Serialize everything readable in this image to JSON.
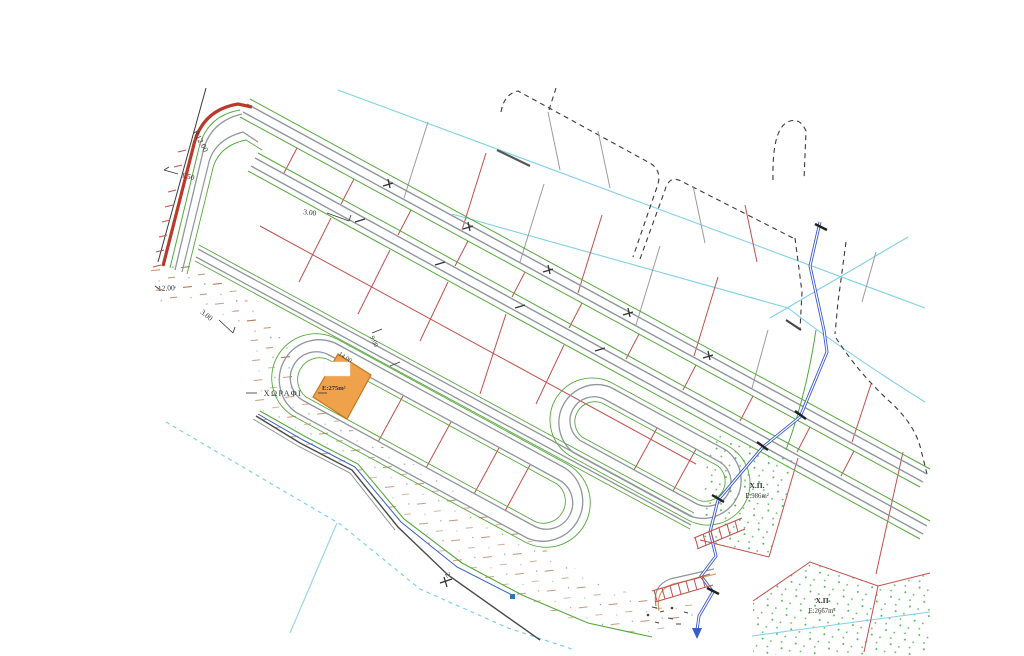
{
  "title": "cadastral-subdivision-plan",
  "labels": {
    "curve_radius": "R12.00",
    "offset_150": "1.50",
    "setback_top": "3.00",
    "dim_left_12": "12.00",
    "setback_left": "3.00",
    "parcel_width": "14.00",
    "road_width": "9.00",
    "dim_bottom_2": "2.",
    "field": "ΧΩΡΑΦΙ"
  },
  "highlight_parcel": {
    "area_label": "E:275m²",
    "fill": "#F0A14B"
  },
  "green_spaces": [
    {
      "name": "Χ.Π.",
      "area": "E:986m²"
    },
    {
      "name": "Χ.Π",
      "area": "E:2667m²"
    }
  ],
  "colors": {
    "parcel_red": "#c0504d",
    "road_gray": "#8f9699",
    "road_green": "#56a83c",
    "stream_blue": "#3b5cc4",
    "cyan_line": "#7fd0e8",
    "boundary_dash": "#3a3a3a",
    "edge_red_thick": "#b93a2b",
    "stipple_green": "#44aa44",
    "hatch_brown": "#b06a40",
    "orange_fill": "#F0A14B"
  }
}
